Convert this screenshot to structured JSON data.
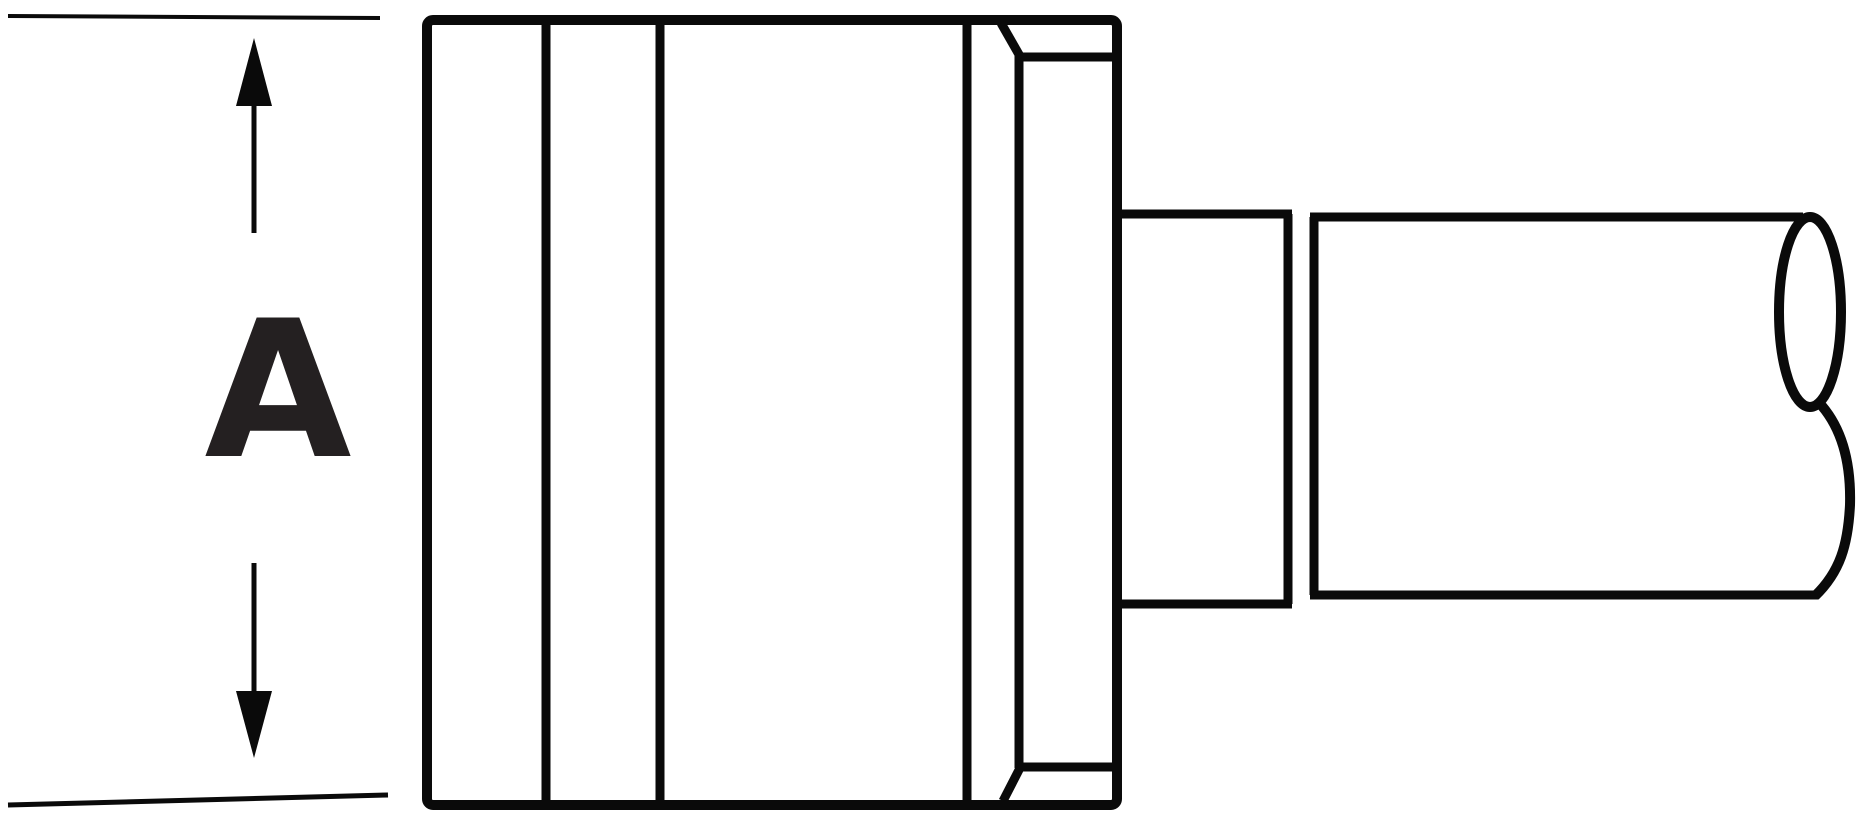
{
  "canvas": {
    "width": 1859,
    "height": 825,
    "background": "#ffffff"
  },
  "drawing": {
    "stroke_color": "#0a0a0a",
    "label_color": "#242021",
    "dimension": {
      "label": "A"
    },
    "parts": [
      "extension-line-top",
      "extension-line-bottom",
      "dimension-arrow-up",
      "dimension-arrow-down",
      "dimension-label",
      "blade-body",
      "blade-face-line-1",
      "blade-face-line-2",
      "blade-face-line-3",
      "hex-collar-face-line",
      "hex-collar-top-edge",
      "hex-collar-bottom-edge",
      "hex-collar-top-chamfer",
      "hex-collar-bottom-chamfer",
      "shaft-neck-top-edge",
      "shaft-neck-bottom-edge",
      "collar-joint-line-left",
      "collar-joint-line-right",
      "shaft-top-edge",
      "shaft-bottom-edge",
      "shaft-end-face-ellipse",
      "shaft-end-break-curve"
    ]
  }
}
